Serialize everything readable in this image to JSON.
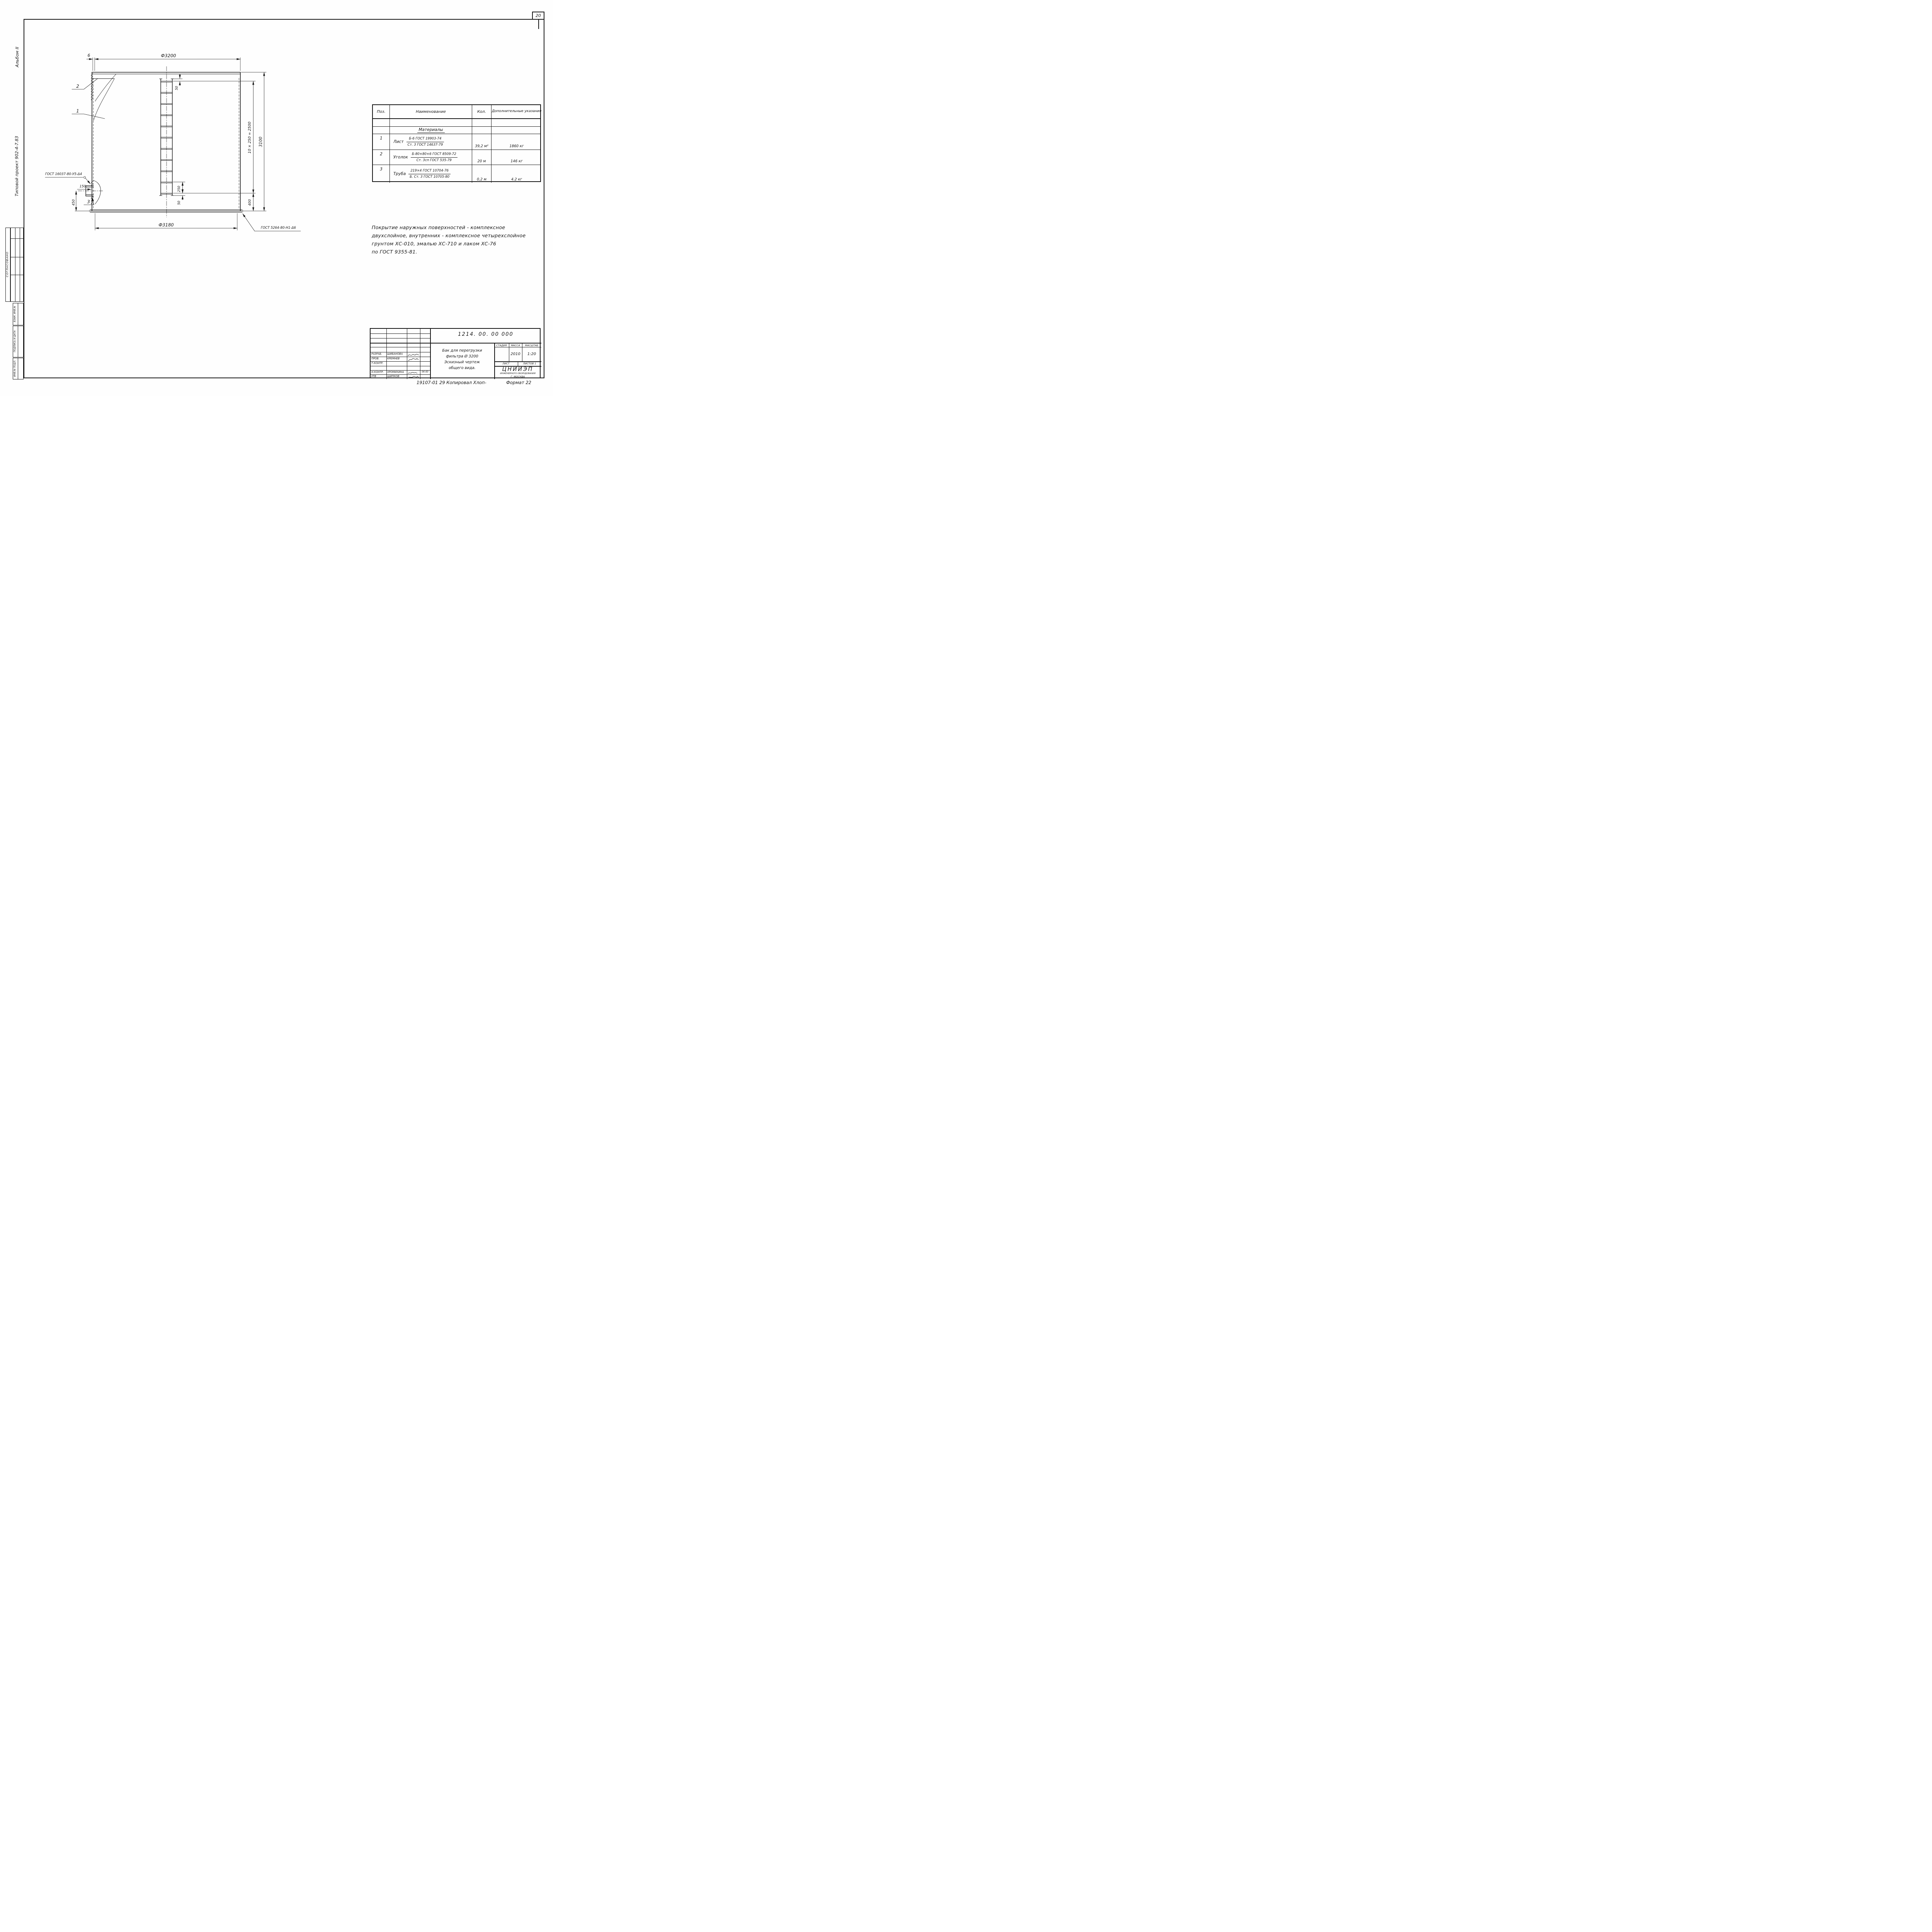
{
  "colors": {
    "ink": "#161616",
    "paper": "#ffffff"
  },
  "page": {
    "number": "20",
    "copy_line": "19107-01 29 Копировал  Хлоп-",
    "format": "Формат 22"
  },
  "margin": {
    "album": "Альбом II",
    "project": "Типовой  проект    902-4-7.83",
    "agreed": "СОГЛАСОВАНО",
    "cell_vzam": "ВЗАМ. ИНВ.№",
    "cell_podpis": "ПОДПИСЬ И ДАТА",
    "cell_inv": "ИНВ.№ ПОДЛ."
  },
  "drawing": {
    "dia_top": "Ф3200",
    "thk": "6",
    "dia_bottom": "Ф3180",
    "h_total": "3100",
    "rung_pitch": "10 × 250 = 2500",
    "h_bottom": "400",
    "d50_top": "50",
    "d250": "250",
    "d50_bottom": "50",
    "nozzle_len": "150",
    "nozzle_h": "450",
    "callout_1": "1",
    "callout_2": "2",
    "callout_3": "3",
    "weld_left": "ГОСТ 16037-80-У5-Δ4",
    "weld_bottom": "ГОСТ 5264-80-Н1-Δ6"
  },
  "table": {
    "h_pos": "Поз.",
    "h_name": "Наименование",
    "h_qty": "Кол.",
    "h_note": "Дополнительные указания",
    "section": "Материалы",
    "rows": [
      {
        "pos": "1",
        "name": "Лист",
        "top": "Б-6  ГОСТ 19903-74",
        "bot": "Ст. 3  ГОСТ 14637-79",
        "qty": "39,2 м²",
        "note": "1860 кг"
      },
      {
        "pos": "2",
        "name": "Уголок",
        "top": "Б-80×80×6  ГОСТ 8509-72",
        "bot": "Ст. 3сп  ГОСТ 535-79",
        "qty": "20 м",
        "note": "146 кг"
      },
      {
        "pos": "3",
        "name": "Труба",
        "top": "219×4  ГОСТ 10704-76",
        "bot": "Б. Ст. 3  ГОСТ 10705-80",
        "qty": "0,2 м",
        "note": "4.2 кг"
      }
    ]
  },
  "notes": {
    "line1": "Покрытие  наружных  поверхностей - комплексное",
    "line2": "двухслойное,  внутренних - комплексное  четырехслойное",
    "line3": "грунтом  ХС-010,  эмалью  ХС-710  и  лаком  ХС-76",
    "line4": "по  ГОСТ 9355-81."
  },
  "stamp": {
    "doc_no": "1214.  00.  00    000",
    "title1": "Бак для  перегрузки",
    "title2": "фильтра  Ø 3200",
    "title3": "Эскизный  чертеж",
    "title4": "общего  вида.",
    "h_stage": "СТАДИЯ",
    "h_mass": "МАССА",
    "h_scale": "МАСШТАБ",
    "mass": "2010",
    "scale": "1:20",
    "h_sheet": "ЛИСТ",
    "h_sheets": "ЛИСТОВ 1",
    "org1": "ЦНИИЭП",
    "org2": "ИНЖЕНЕРНОГО ОБОРУДОВАНИЯ",
    "org3": "Г. МОСКВА",
    "r1_role": "РАЗРАБ.",
    "r1_name": "ШИБАНОВА",
    "r2_role": "ПРОВ.",
    "r2_name": "КРЕМНЕВ",
    "r3_role": "Т.КОНТР.",
    "r3_name": "",
    "r4_role": "Н.КОНТР.",
    "r4_name": "ХРОМИХИНА",
    "r4_date": "06 83",
    "r5_role": "УТВ",
    "r5_name": "ШИПКОВ"
  }
}
